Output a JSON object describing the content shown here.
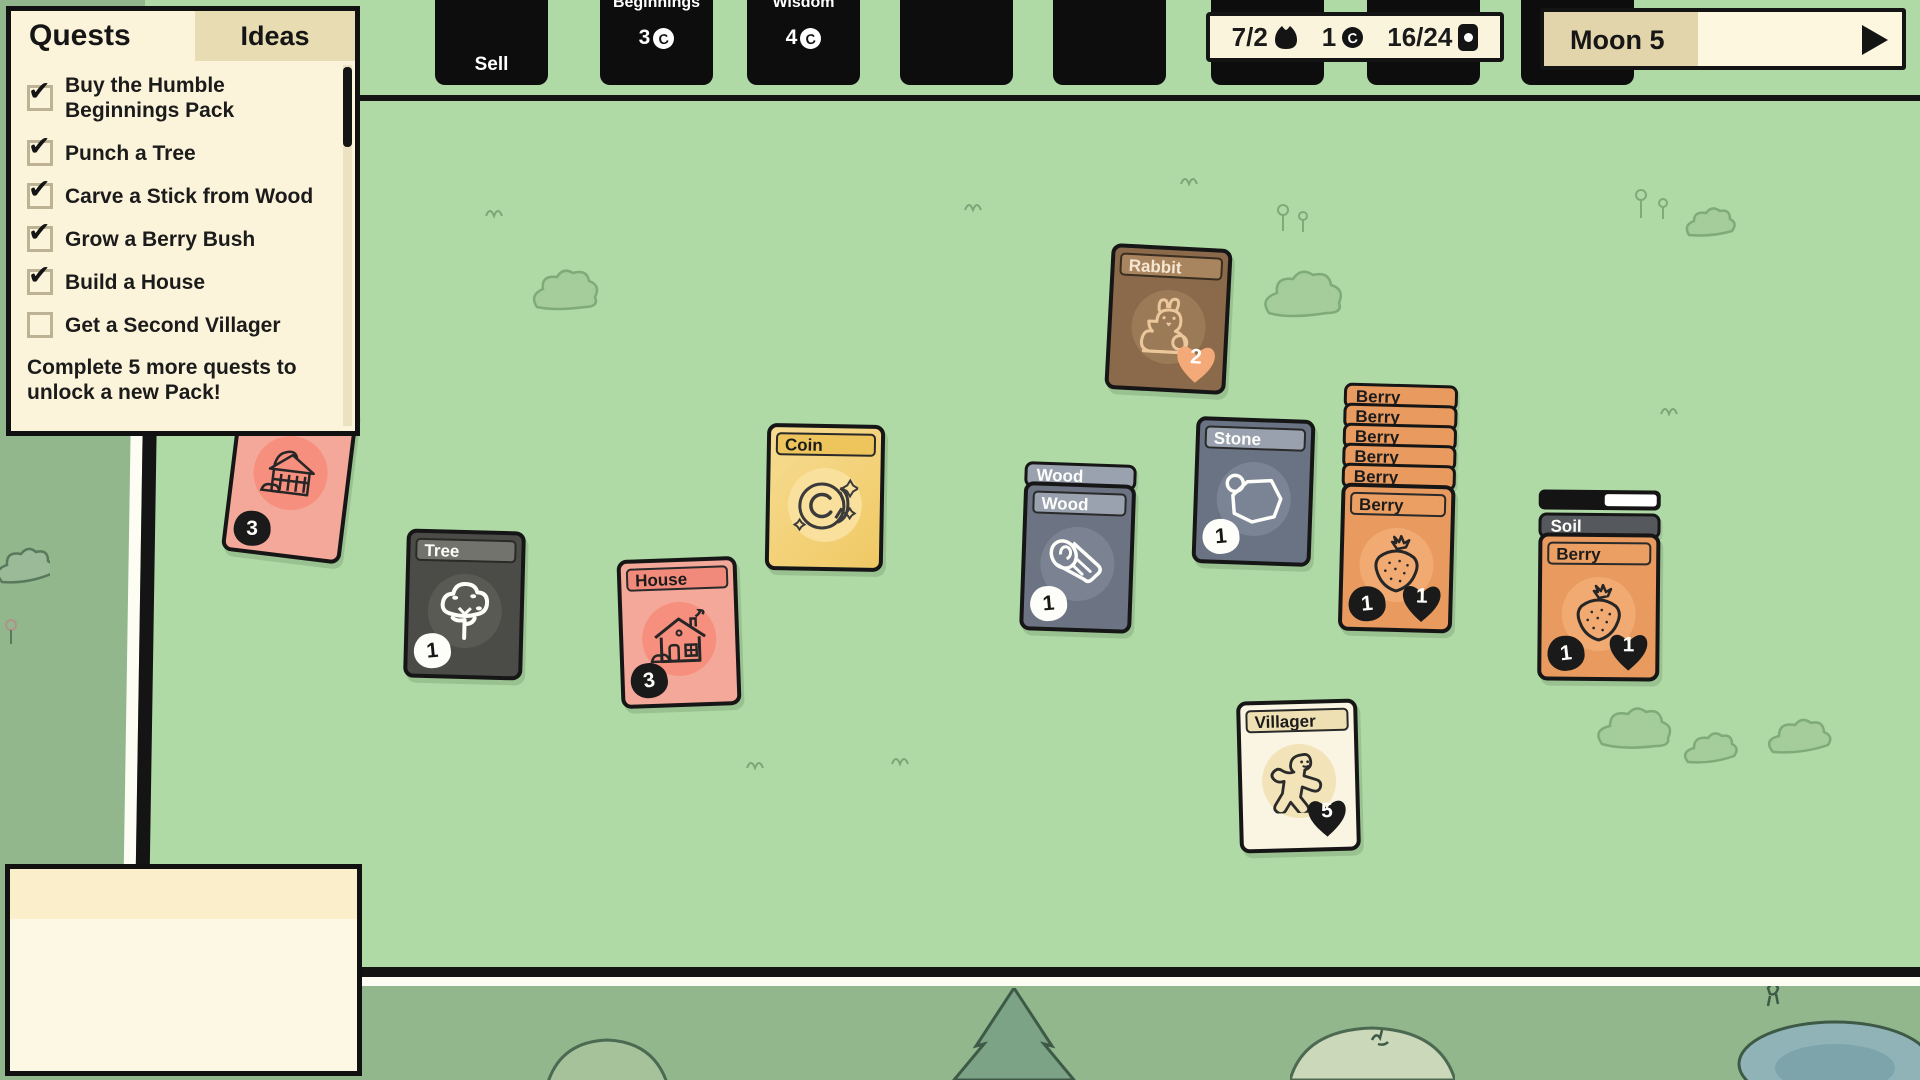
{
  "palette": {
    "board_green": "#afd9a5",
    "outside_green": "#92b78d",
    "panel_cream": "#fbf4da",
    "tab_tan": "#e7dcb2",
    "moon_fill_tan": "#e2d4ab",
    "card_black": "#0d0d0d",
    "rabbit_brown": "#8a6a4b",
    "coin_gold": "#f5d57e",
    "tree_gray": "#4b4b47",
    "house_pink": "#f3a89a",
    "wood_slate": "#6c7383",
    "stone_slate": "#6a7383",
    "berry_orange": "#e99a5f",
    "soil_gray": "#55585c",
    "villager_cream": "#faf5e3",
    "heart_orange": "#f4a978"
  },
  "icons": {
    "coin_letter": "C"
  },
  "quest_panel": {
    "tab_quests": "Quests",
    "tab_ideas": "Ideas",
    "items": [
      {
        "label": "Buy the Humble Beginnings Pack",
        "checked": true
      },
      {
        "label": "Punch a Tree",
        "checked": true
      },
      {
        "label": "Carve a Stick from Wood",
        "checked": true
      },
      {
        "label": "Grow a Berry Bush",
        "checked": true
      },
      {
        "label": "Build a House",
        "checked": true
      },
      {
        "label": "Get a Second Villager",
        "checked": false
      }
    ],
    "footer": "Complete 5 more quests to unlock a new Pack!"
  },
  "top_bar": {
    "sell_label": "Sell",
    "packs": [
      {
        "name": "Beginnings",
        "cost": "3"
      },
      {
        "name": "Wisdom",
        "cost": "4"
      }
    ],
    "stats": {
      "food": "7/2",
      "coins": "1",
      "cards": "16/24"
    },
    "moon": {
      "label": "Moon 5",
      "progress_percent": 43
    }
  },
  "cards": {
    "rabbit": {
      "title": "Rabbit",
      "hearts": "2"
    },
    "coin": {
      "title": "Coin"
    },
    "tree": {
      "title": "Tree",
      "count": "1"
    },
    "house": {
      "title": "House",
      "count": "3"
    },
    "wood": {
      "title": "Wood",
      "count": "1"
    },
    "stone": {
      "title": "Stone",
      "count": "1"
    },
    "berry": {
      "title": "Berry",
      "count": "1",
      "hearts": "1"
    },
    "soil": {
      "title": "Soil"
    },
    "soil_berry": {
      "title": "Berry",
      "count": "1",
      "hearts": "1"
    },
    "villager": {
      "title": "Villager",
      "hearts": "5"
    },
    "hidden_structure": {
      "count": "3"
    }
  }
}
